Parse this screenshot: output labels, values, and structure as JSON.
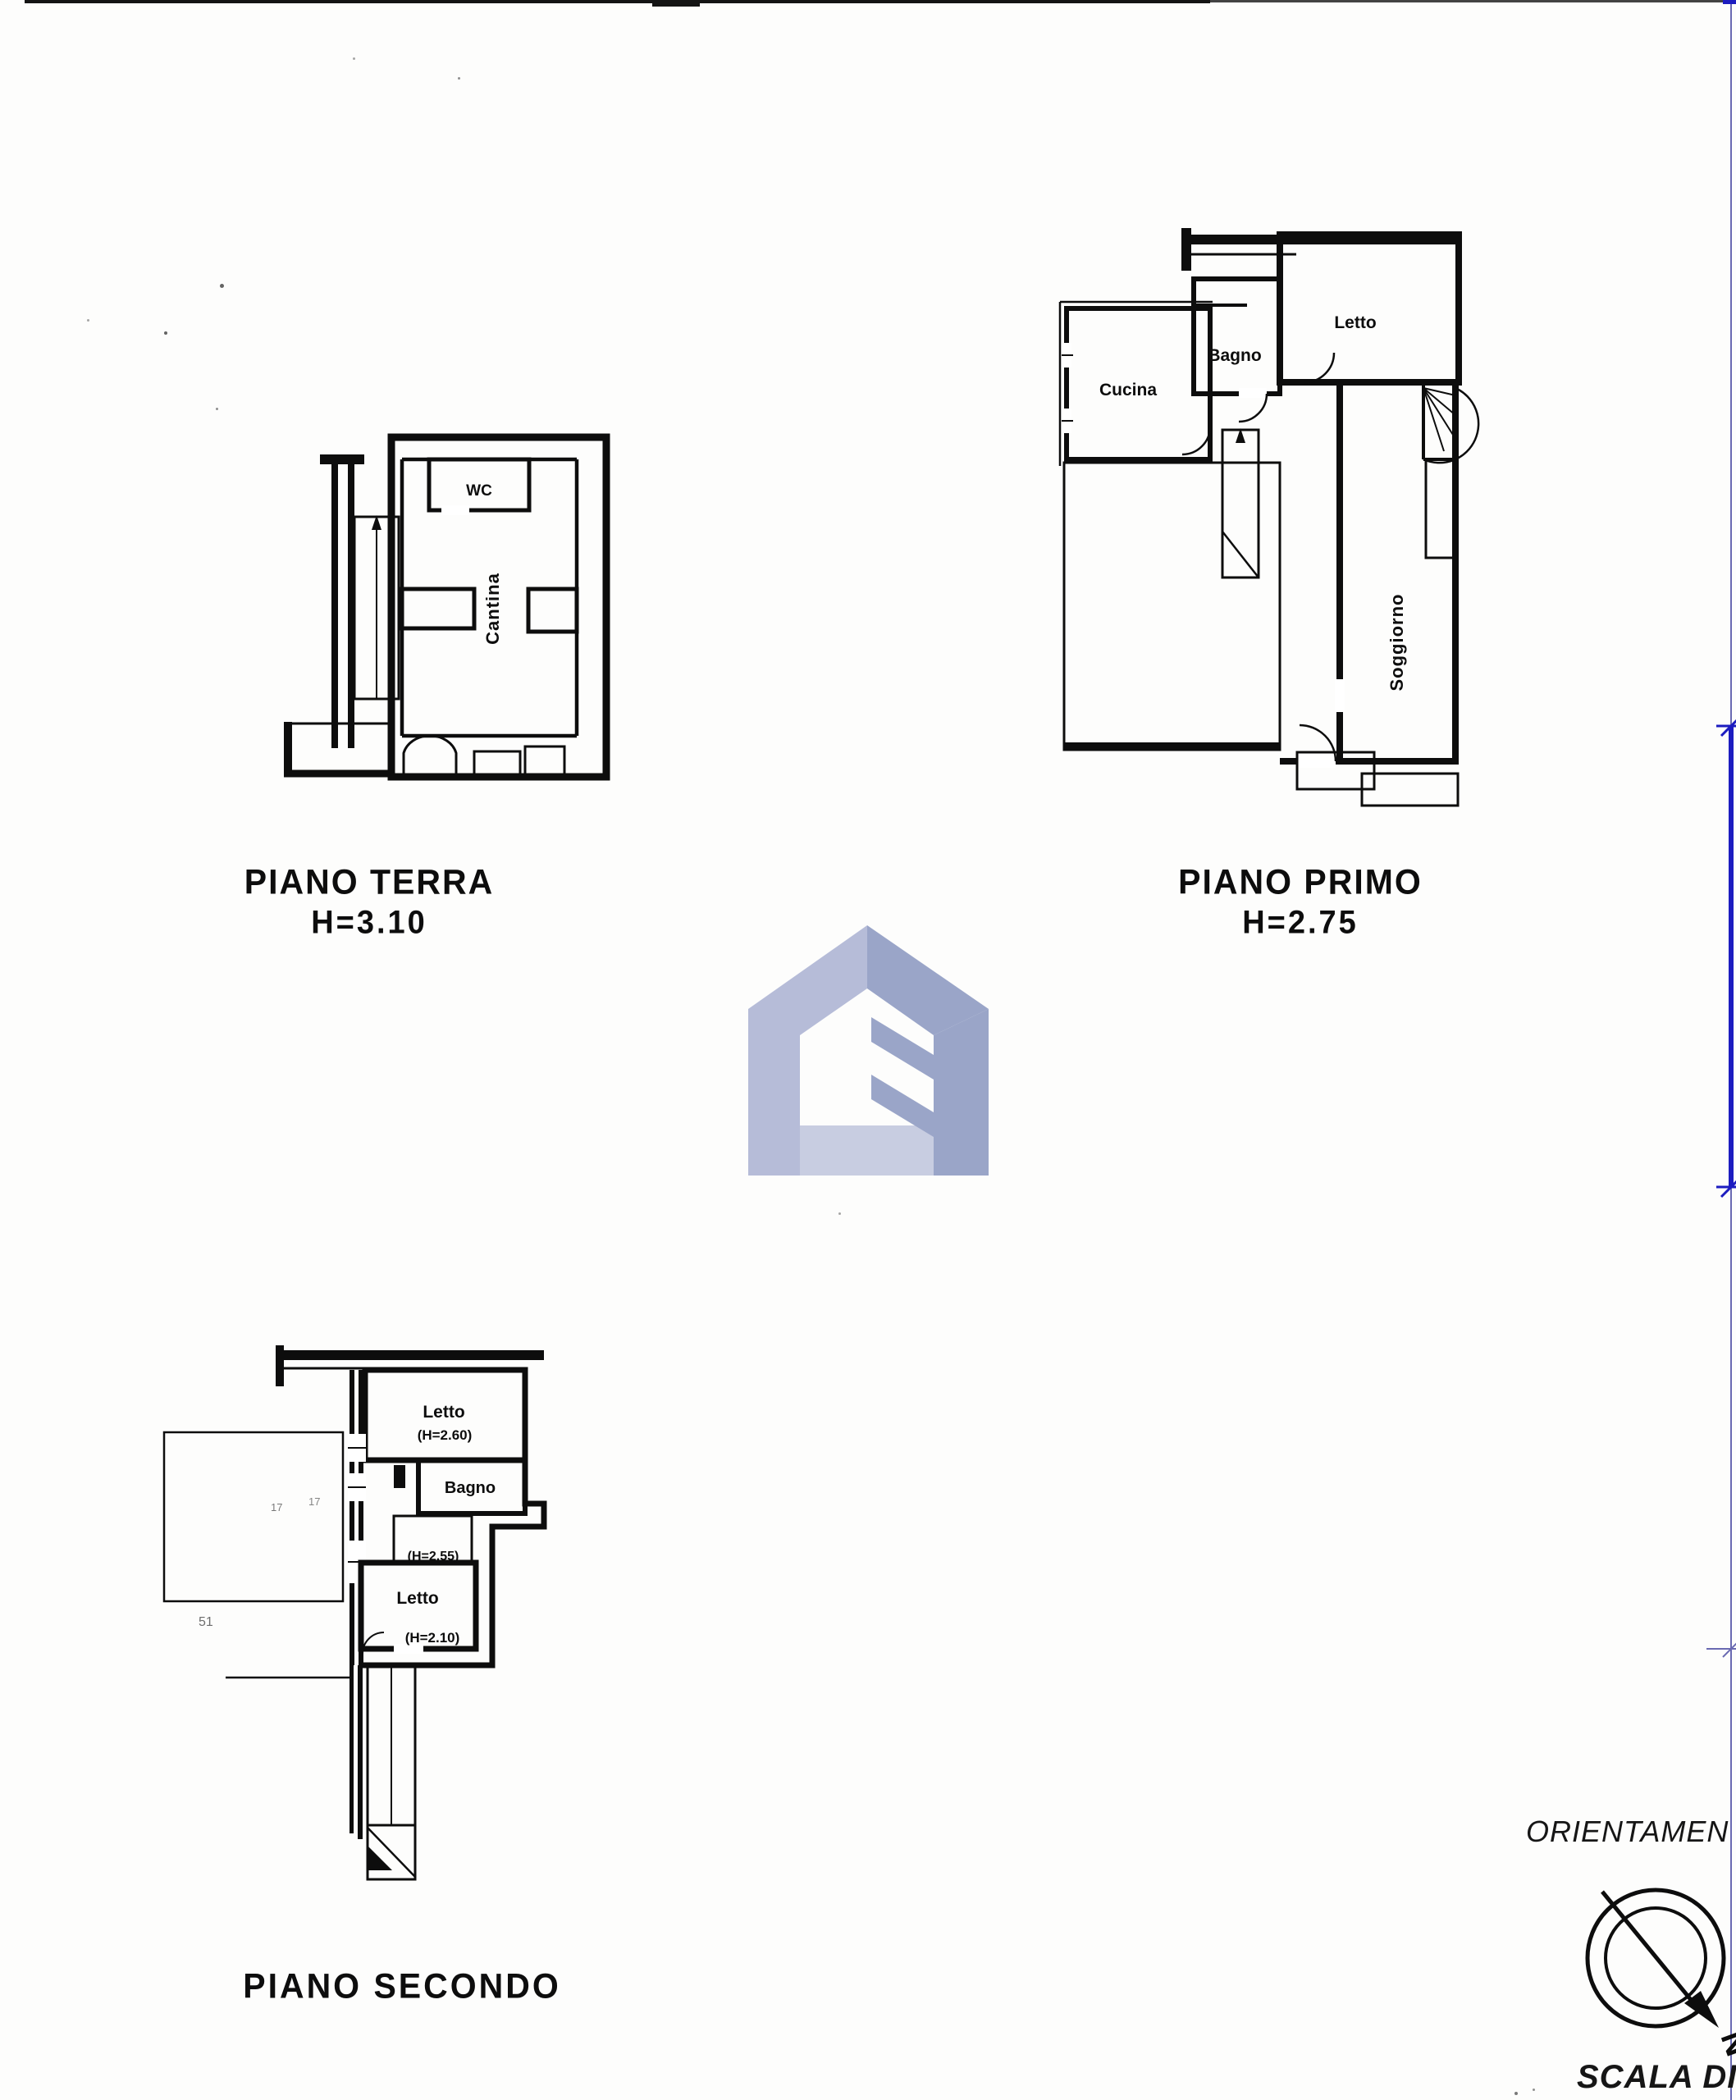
{
  "floors": {
    "terra": {
      "caption": "PIANO TERRA",
      "height_label": "H=3.10",
      "rooms": {
        "wc": "WC",
        "cantina": "Cantina"
      }
    },
    "primo": {
      "caption": "PIANO PRIMO",
      "height_label": "H=2.75",
      "rooms": {
        "cucina": "Cucina",
        "bagno": "Bagno",
        "letto": "Letto",
        "soggiorno": "Soggiorno"
      }
    },
    "secondo": {
      "caption": "PIANO SECONDO",
      "rooms": {
        "letto_alto": "Letto",
        "letto_alto_h": "(H=2.60)",
        "bagno": "Bagno",
        "vano_h": "(H=2.55)",
        "letto_basso": "Letto",
        "letto_basso_h": "(H=2.10)"
      },
      "annotations": {
        "mark_a": "17",
        "mark_b": "17",
        "mark_c": "51"
      }
    }
  },
  "orientation": {
    "label": "ORIENTAMEN",
    "north": "N"
  },
  "scale_note": "SCALA DI 1:",
  "colors": {
    "ink": "#0d0d0d",
    "watermark_light": "#b6bcd8",
    "watermark_dark": "#9aa5c8",
    "watermark_band": "#c8cde1",
    "ref_thin": "#6a6ab2",
    "ref_thick": "#1c1cc0"
  }
}
